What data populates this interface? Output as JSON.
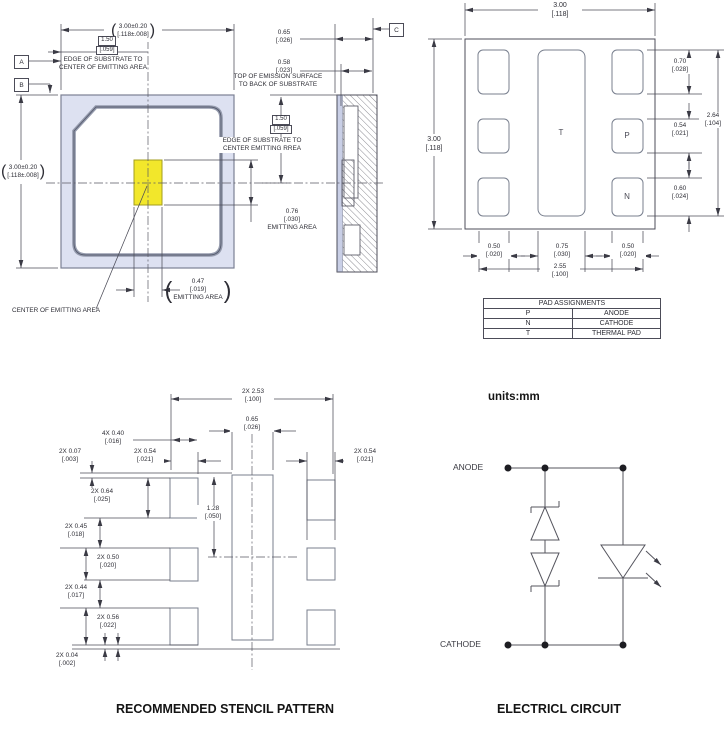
{
  "glyphs": {
    "paren_open": "(",
    "paren_close": ")"
  },
  "front_view": {
    "dim_width": {
      "mm": "3.00±0.20",
      "inch": "[.118±.008]"
    },
    "dim_height": {
      "mm": "3.00±0.20",
      "inch": "[.118±.008]"
    },
    "dim_edge_center": {
      "mm": "1.50",
      "inch": "[.059]"
    },
    "edge_note": {
      "line1": "EDGE OF SUBSTRATE TO",
      "line2": "CENTER OF EMITTING AREA"
    },
    "datum_a": "A",
    "datum_b": "B",
    "emitting_height": {
      "mm": "0.76",
      "inch": "[.030]",
      "label": "EMITTING AREA"
    },
    "emitting_width": {
      "mm": "0.47",
      "inch": "[.019]",
      "label": "EMITTING AREA"
    },
    "center_note": "CENTER OF EMITTING AREA"
  },
  "side_view": {
    "datum_c": "C",
    "dim_thickness": {
      "mm": "0.65",
      "inch": "[.026]"
    },
    "dim_emission": {
      "mm": "0.58",
      "inch": "[.023]"
    },
    "emission_note": {
      "line1": "TOP OF EMISSION SURFACE",
      "line2": "TO BACK OF SUBSTRATE"
    },
    "dim_edge_center": {
      "mm": "1.50",
      "inch": "[.059]"
    },
    "edge_note": {
      "line1": "EDGE OF SUBSTRATE TO",
      "line2": "CENTER EMITTING RREA"
    }
  },
  "bottom_view": {
    "dim_width": {
      "mm": "3.00",
      "inch": "[.118]"
    },
    "dim_height": {
      "mm": "3.00",
      "inch": "[.118]"
    },
    "pad_labels": {
      "thermal": "T",
      "anode": "P",
      "cathode": "N"
    },
    "dim_top_pad": {
      "mm": "0.70",
      "inch": "[.028]"
    },
    "dim_pad_span": {
      "mm": "2.64",
      "inch": "[.104]"
    },
    "dim_p_pad": {
      "mm": "0.54",
      "inch": "[.021]"
    },
    "dim_n_pad": {
      "mm": "0.60",
      "inch": "[.024]"
    },
    "dim_left_col": {
      "mm": "0.50",
      "inch": "[.020]"
    },
    "dim_center_col": {
      "mm": "0.75",
      "inch": "[.030]"
    },
    "dim_right_col": {
      "mm": "0.50",
      "inch": "[.020]"
    },
    "dim_col_span": {
      "mm": "2.55",
      "inch": "[.100]"
    }
  },
  "pad_table": {
    "title": "PAD ASSIGNMENTS",
    "rows": [
      [
        "P",
        "ANODE"
      ],
      [
        "N",
        "CATHODE"
      ],
      [
        "T",
        "THERMAL PAD"
      ]
    ]
  },
  "stencil": {
    "dim_span": {
      "mm": "2X 2.53",
      "inch": "[.100]"
    },
    "dim_center_width": {
      "mm": "0.65",
      "inch": "[.026]"
    },
    "dim_gap": {
      "mm": "4X 0.40",
      "inch": "[.016]"
    },
    "dim_offset_top": {
      "mm": "2X 0.07",
      "inch": "[.003]"
    },
    "dim_col_left": {
      "mm": "2X 0.54",
      "inch": "[.021]"
    },
    "dim_col_right": {
      "mm": "2X 0.54",
      "inch": "[.021]"
    },
    "dim_row1": {
      "mm": "2X 0.64",
      "inch": "[.025]"
    },
    "dim_gap1": {
      "mm": "2X 0.45",
      "inch": "[.018]"
    },
    "dim_row2": {
      "mm": "2X 0.50",
      "inch": "[.020]"
    },
    "dim_gap2": {
      "mm": "2X 0.44",
      "inch": "[.017]"
    },
    "dim_row3": {
      "mm": "2X 0.56",
      "inch": "[.022]"
    },
    "dim_offset_bottom": {
      "mm": "2X 0.04",
      "inch": "[.002]"
    },
    "dim_center_half": {
      "mm": "1.28",
      "inch": "[.050]"
    },
    "title": "RECOMMENDED STENCIL PATTERN"
  },
  "circuit": {
    "units_note": "units:mm",
    "anode_label": "ANODE",
    "cathode_label": "CATHODE",
    "title": "ELECTRICL CIRCUIT"
  },
  "colors": {
    "substrate_fill": "#dde1f1",
    "emitting_area_fill": "#f2e72b",
    "line": "#4c4c58"
  }
}
